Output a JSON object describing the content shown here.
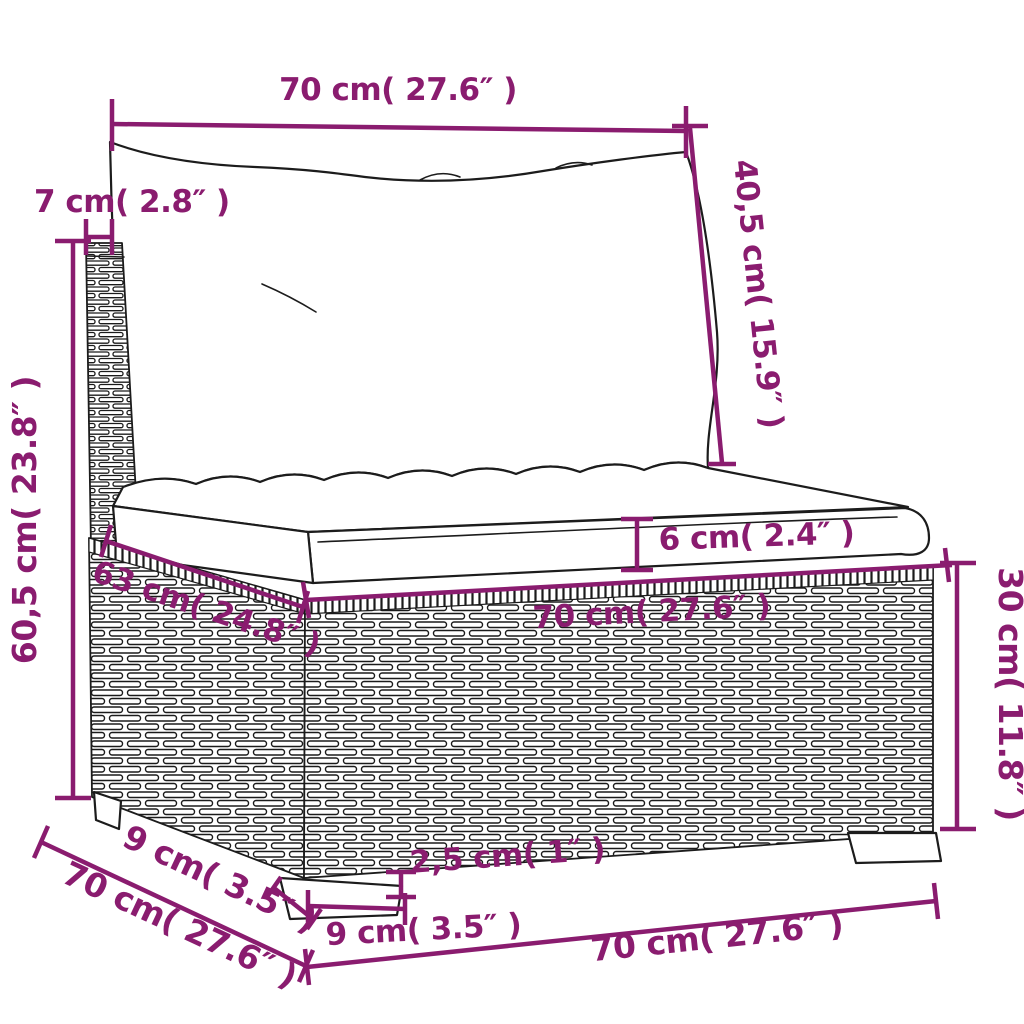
{
  "diagram": {
    "kind": "furniture-dimension-diagram",
    "subject": "rattan-sofa-middle-section-with-cushions",
    "colors": {
      "dimension": "#8A1C6F",
      "line_art": "#1c1c1c",
      "background": "#ffffff"
    },
    "labels": {
      "back_width": "70 cm( 27.6″ )",
      "back_depth": "7 cm( 2.8″ )",
      "back_cushion_height": "40,5 cm( 15.9″ )",
      "total_height": "60,5 cm( 23.8″ )",
      "seat_thickness": "6 cm( 2.4″ )",
      "seat_width": "70 cm( 27.6″ )",
      "base_depth_top": "63 cm( 24.8″ )",
      "base_height": "30 cm( 11.8″ )",
      "foot_height": "2,5 cm( 1″ )",
      "foot_width_front": "9 cm( 3.5″ )",
      "foot_depth_side": "9 cm( 3.5″ )",
      "base_depth_bottom": "70 cm( 27.6″ )",
      "base_width_bottom": "70 cm( 27.6″ )"
    }
  }
}
